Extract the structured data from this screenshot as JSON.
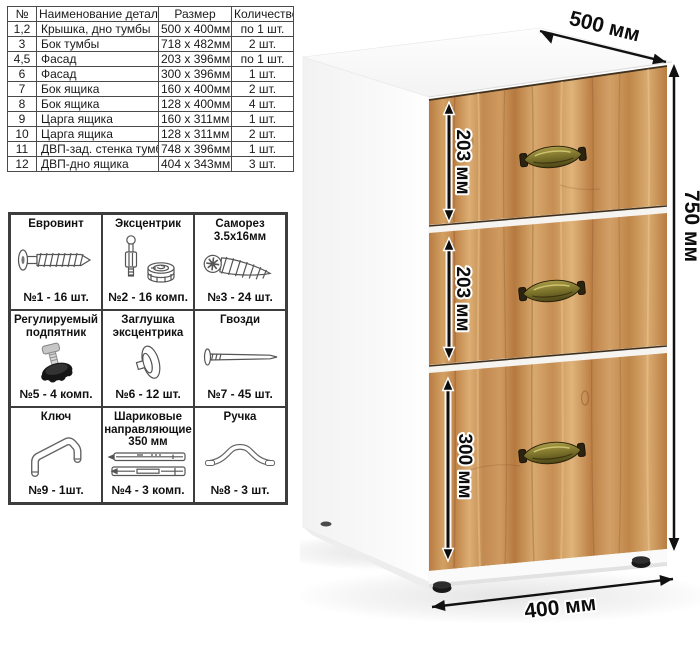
{
  "parts_table": {
    "headers": [
      "№",
      "Наименование детали",
      "Размер",
      "Количество"
    ],
    "rows": [
      [
        "1,2",
        "Крышка, дно тумбы",
        "500 x 400мм",
        "по 1 шт."
      ],
      [
        "3",
        "Бок тумбы",
        "718 x 482мм",
        "2 шт."
      ],
      [
        "4,5",
        "Фасад",
        "203 x 396мм",
        "по 1 шт."
      ],
      [
        "6",
        "Фасад",
        "300 x 396мм",
        "1 шт."
      ],
      [
        "7",
        "Бок ящика",
        "160 x 400мм",
        "2 шт."
      ],
      [
        "8",
        "Бок ящика",
        "128 x 400мм",
        "4 шт."
      ],
      [
        "9",
        "Царга ящика",
        "160 x 311мм",
        "1 шт."
      ],
      [
        "10",
        "Царга ящика",
        "128 x 311мм",
        "2 шт."
      ],
      [
        "11",
        "ДВП-зад. стенка тумбы",
        "748 x 396мм",
        "1 шт."
      ],
      [
        "12",
        "ДВП-дно ящика",
        "404 x 343мм",
        "3 шт."
      ]
    ]
  },
  "hardware": {
    "items": [
      {
        "title": "Евровинт",
        "count": "№1 - 16 шт.",
        "icon": "euro-screw-icon"
      },
      {
        "title": "Эксцентрик",
        "count": "№2 - 16 комп.",
        "icon": "eccentric-cam-icon"
      },
      {
        "title": "Саморез 3.5х16мм",
        "count": "№3 - 24 шт.",
        "icon": "self-tapping-screw-icon"
      },
      {
        "title": "Регулируемый подпятник",
        "count": "№5 - 4 комп.",
        "icon": "adjustable-foot-icon"
      },
      {
        "title": "Заглушка эксцентрика",
        "count": "№6 - 12 шт.",
        "icon": "cam-cover-icon"
      },
      {
        "title": "Гвозди",
        "count": "№7 - 45 шт.",
        "icon": "nail-icon"
      },
      {
        "title": "Ключ",
        "count": "№9 - 1шт.",
        "icon": "allen-key-icon"
      },
      {
        "title": "Шариковые направляющие 350 мм",
        "count": "№4 - 3 комп.",
        "icon": "ball-bearing-slides-icon"
      },
      {
        "title": "Ручка",
        "count": "№8 - 3 шт.",
        "icon": "handle-icon"
      }
    ]
  },
  "cabinet": {
    "dimensions": {
      "width": "500 мм",
      "height": "750 мм",
      "depth": "400 мм"
    },
    "drawer_heights": [
      "203 мм",
      "203 мм",
      "300 мм"
    ],
    "colors": {
      "wood": "#c68e53",
      "carcass": "#ffffff",
      "handle_brass": "#7a7430",
      "dimension": "#111111"
    }
  }
}
